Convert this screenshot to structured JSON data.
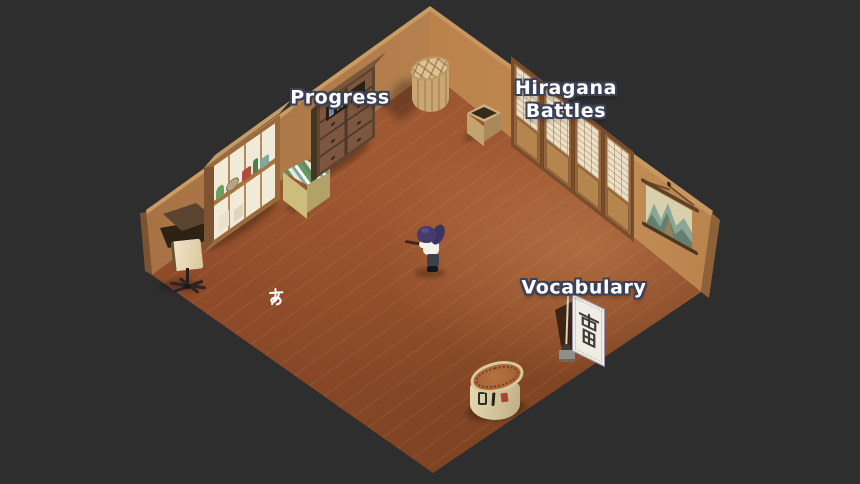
{
  "scene": {
    "name": "japanese-language-learning-room",
    "view": "isometric-room"
  },
  "hud": {
    "progress_label": "Progress",
    "hiragana_battles_label": "Hiragana Battles",
    "hiragana_battles_line1": "Hiragana",
    "hiragana_battles_line2": "Battles",
    "vocabulary_label": "Vocabulary"
  },
  "floor": {
    "hiragana_character": "あ"
  },
  "vocabulary_banner": {
    "kanji": "雷"
  },
  "colors": {
    "background": "#2e2e2e",
    "floor": "#8e4a29",
    "wall_left": "#b5804e",
    "wall_right": "#b97f48",
    "shoji_paper": "#ece1c8",
    "banner_paper": "#f0ede4",
    "accent_red": "#a84434",
    "label_text": "#ffffff",
    "label_outline": "#3c4156"
  }
}
